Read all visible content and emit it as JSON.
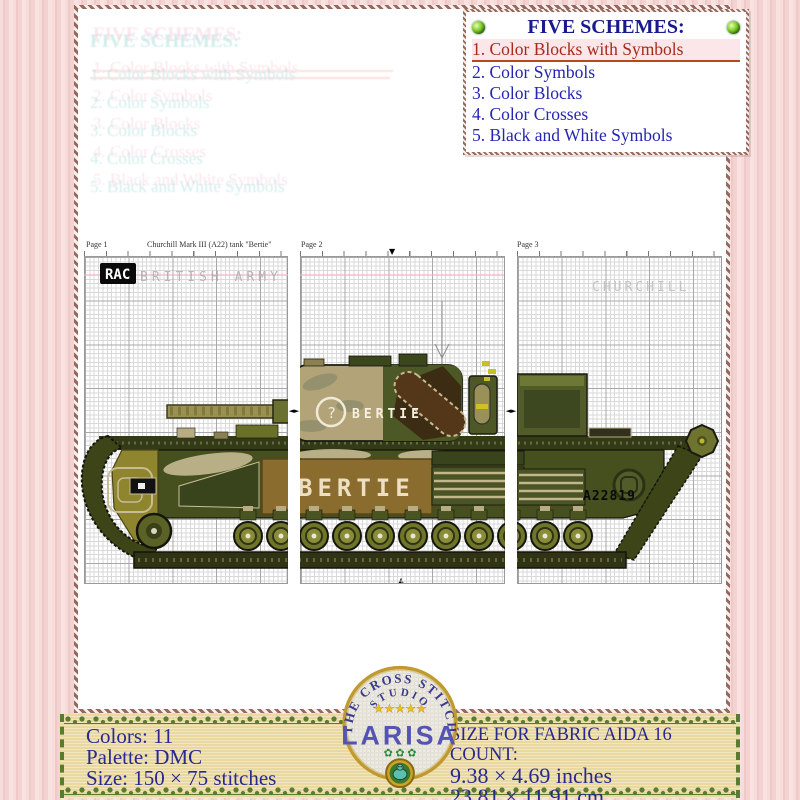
{
  "schemes": {
    "title": "FIVE SCHEMES:",
    "items": [
      "1. Color Blocks with Symbols",
      "2. Color Symbols",
      "3. Color Blocks",
      "4. Color Crosses",
      "5. Black and White Symbols"
    ]
  },
  "chart": {
    "header": {
      "page1": "Page 1",
      "title": "Churchill Mark III (A22) tank \"Bertie\"",
      "page2": "Page 2",
      "page3": "Page 3"
    },
    "markings": {
      "rac": "RAC",
      "army": "BRITISH ARMY",
      "churchill": "CHURCHILL",
      "turret_symbol": "?",
      "turret_name": "BERTIE",
      "hull_name": "BERTIE",
      "serial": "A22819"
    },
    "markers": {
      "down": "▼",
      "up": "▲",
      "pair": "◄►"
    }
  },
  "footer": {
    "left": {
      "colors": "Colors: 11",
      "palette": "Palette: DMC",
      "size": "Size: 150 × 75 stitches"
    },
    "right": {
      "heading": "SIZE FOR FABRIC AIDA 16 COUNT:",
      "inches": "9.38 × 4.69 inches",
      "cm": "23.81 × 11.91 cm"
    },
    "logo": {
      "arc_top": "THE CROSS STITCH",
      "arc_mid": "STUDIO",
      "stars": "★★★★★",
      "name": "LARISA",
      "motifs": "✿ ✿ ✿"
    }
  },
  "colors": {
    "scheme_active_red": "#a82a18",
    "scheme_blue": "#2525b2",
    "banner_green": "#5a7c2e",
    "banner_bg": "#e9d8a0",
    "tank_olive": "#4e5826",
    "tank_tan": "#b2a478"
  }
}
